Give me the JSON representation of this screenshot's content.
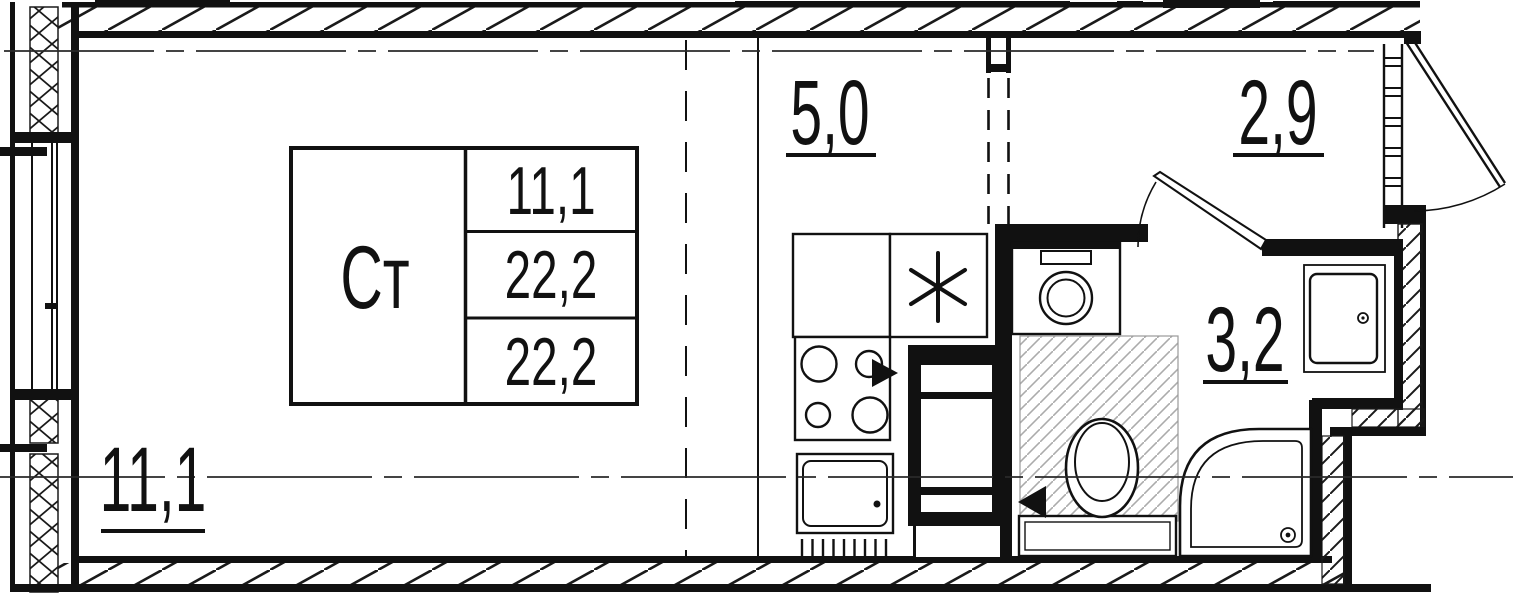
{
  "unit_card": {
    "type_label": "Ст",
    "area_rows": [
      "11,1",
      "22,2",
      "22,2"
    ]
  },
  "room_areas": {
    "living": "11,1",
    "kitchen": "5,0",
    "hall": "2,9",
    "bathroom": "3,2"
  },
  "symbols": {
    "kitchen_marker": "*"
  },
  "colors": {
    "line": "#111111",
    "hatch_light": "#ababab"
  }
}
